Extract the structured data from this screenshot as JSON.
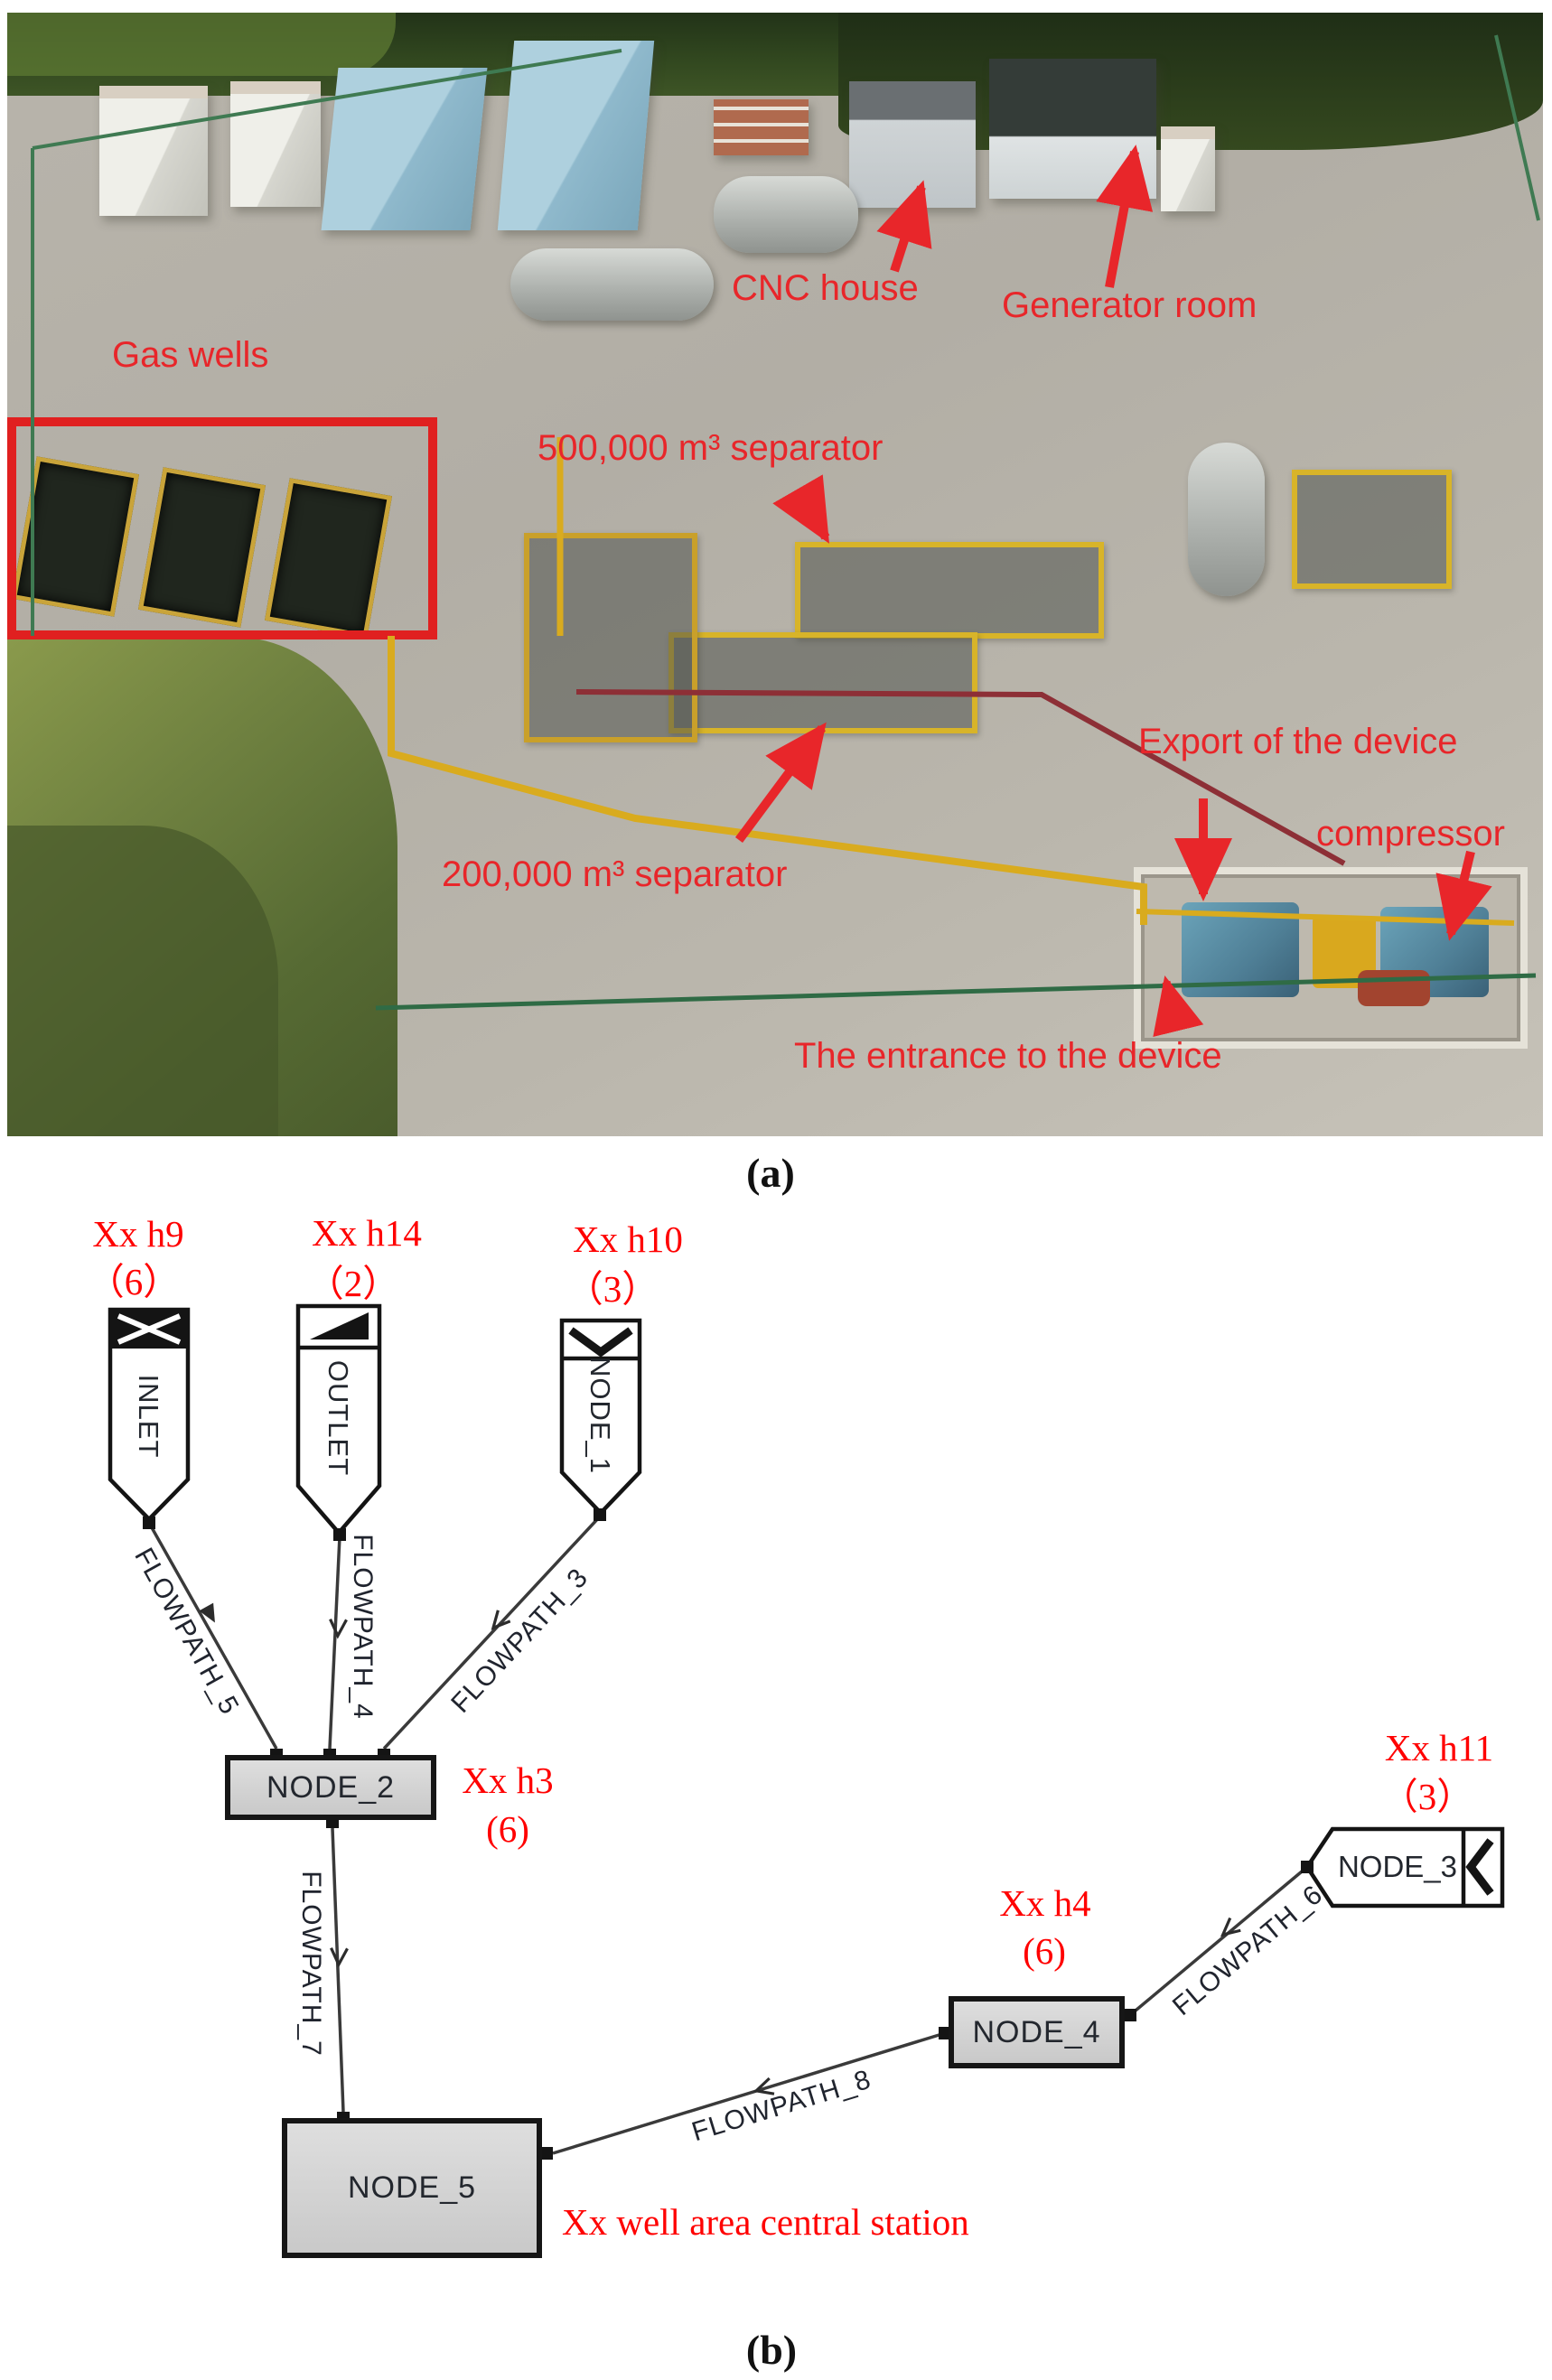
{
  "figure_a": {
    "caption": "(a)",
    "annotation_color": "#e8262a",
    "annotations": {
      "gas_wells": "Gas wells",
      "cnc_house": "CNC house",
      "generator_room": "Generator room",
      "separator_500k": "500,000 m³ separator",
      "separator_200k": "200,000 m³ separator",
      "export_of_device": "Export of the device",
      "compressor": "compressor",
      "entrance_of_device": "The entrance to the device"
    }
  },
  "figure_b": {
    "caption": "(b)",
    "label_color": "#ff0000",
    "nodes": [
      {
        "id": "inlet",
        "label": "INLET",
        "type": "source-boundary"
      },
      {
        "id": "outlet",
        "label": "OUTLET",
        "type": "sink-boundary"
      },
      {
        "id": "node_1",
        "label": "NODE_1",
        "type": "boundary"
      },
      {
        "id": "node_2",
        "label": "NODE_2",
        "type": "junction"
      },
      {
        "id": "node_3",
        "label": "NODE_3",
        "type": "boundary"
      },
      {
        "id": "node_4",
        "label": "NODE_4",
        "type": "junction"
      },
      {
        "id": "node_5",
        "label": "NODE_5",
        "type": "junction"
      }
    ],
    "edges": [
      {
        "label": "FLOWPATH_5",
        "from": "INLET",
        "to": "NODE_2"
      },
      {
        "label": "FLOWPATH_4",
        "from": "OUTLET",
        "to": "NODE_2"
      },
      {
        "label": "FLOWPATH_3",
        "from": "NODE_1",
        "to": "NODE_2"
      },
      {
        "label": "FLOWPATH_7",
        "from": "NODE_2",
        "to": "NODE_5"
      },
      {
        "label": "FLOWPATH_6",
        "from": "NODE_3",
        "to": "NODE_4"
      },
      {
        "label": "FLOWPATH_8",
        "from": "NODE_4",
        "to": "NODE_5"
      }
    ],
    "well_labels": [
      {
        "name": "Xx h9",
        "count": "（6）"
      },
      {
        "name": "Xx h14",
        "count": "（2）"
      },
      {
        "name": "Xx h10",
        "count": "（3）"
      },
      {
        "name": "Xx h3",
        "count": "(6)"
      },
      {
        "name": "Xx h11",
        "count": "（3）"
      },
      {
        "name": "Xx h4",
        "count": "(6)"
      }
    ],
    "station_label": "Xx well area central station"
  }
}
